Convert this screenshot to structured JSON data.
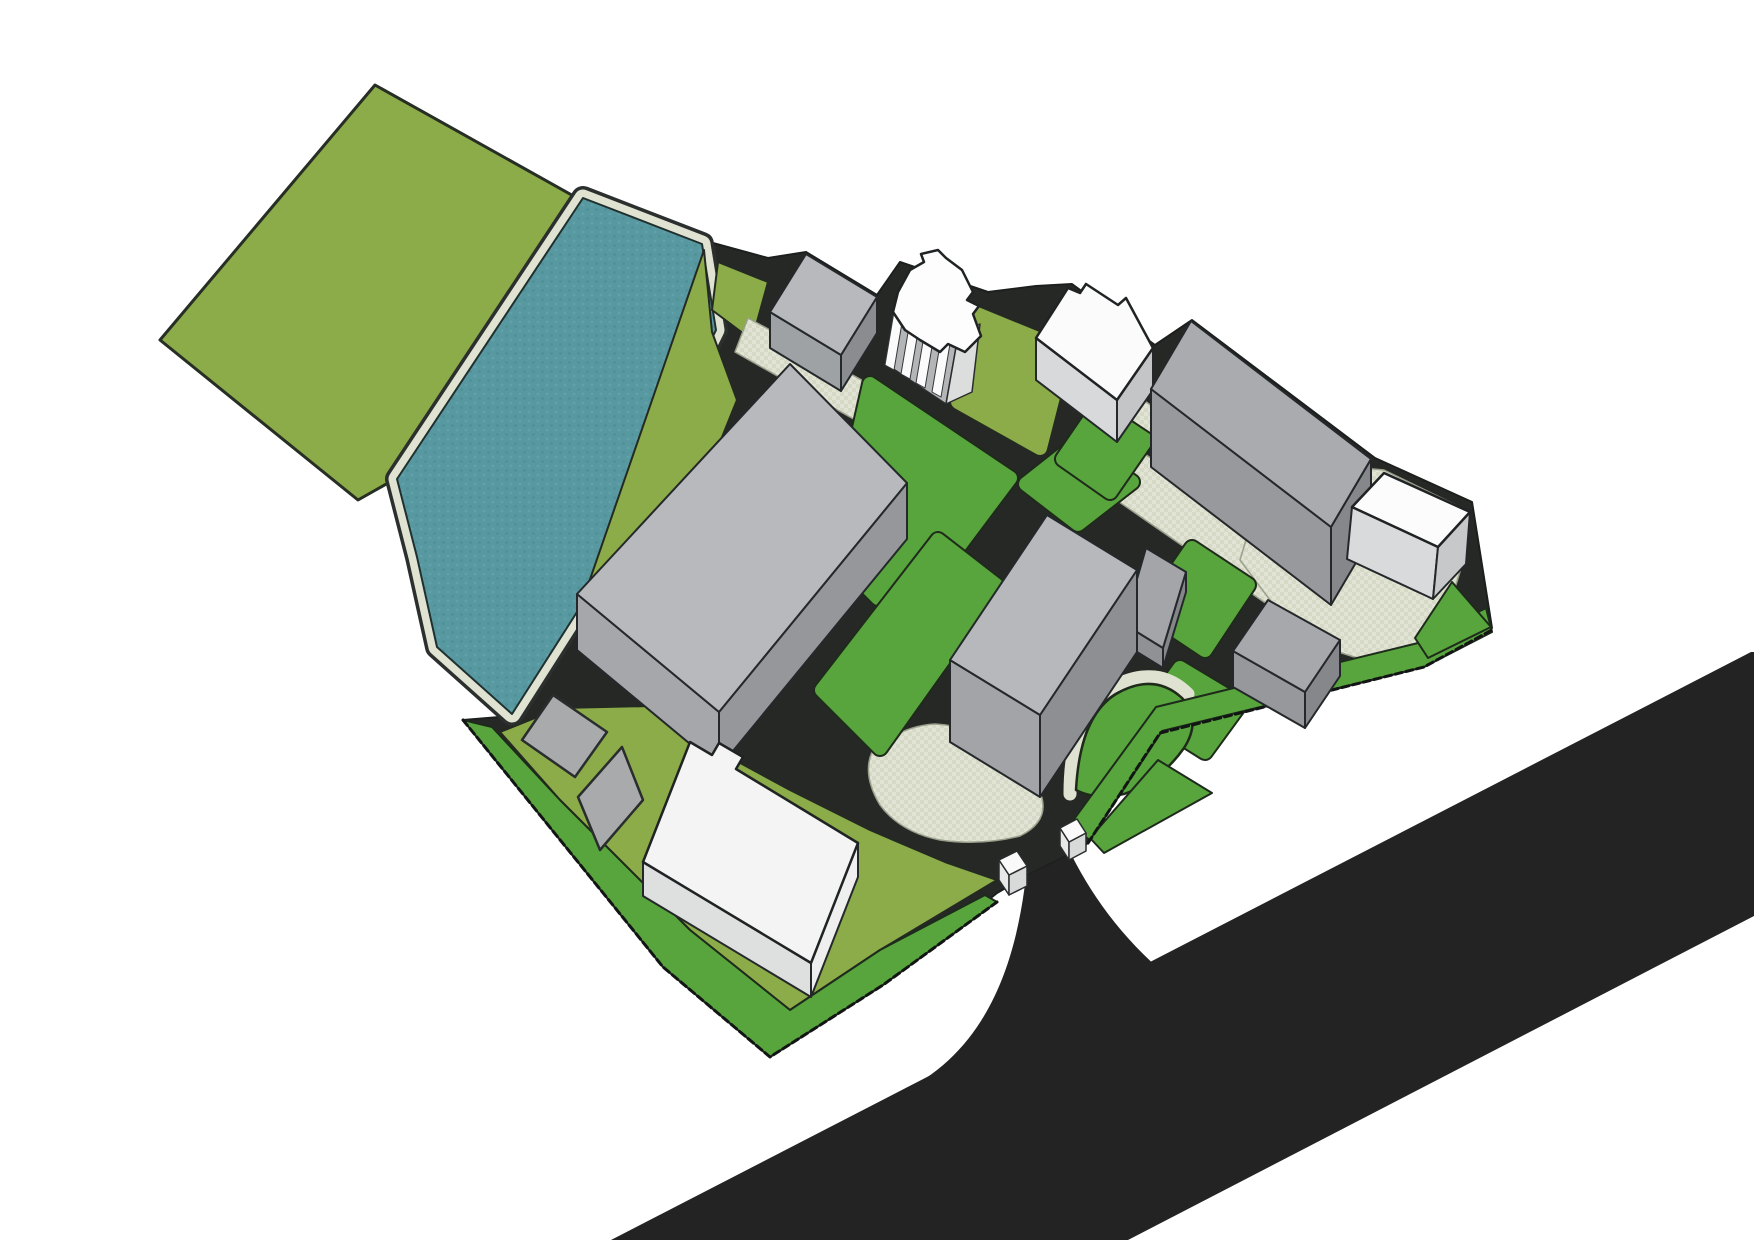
{
  "canvas": {
    "width": 1754,
    "height": 1240,
    "background": "#ffffff"
  },
  "scene": {
    "kind": "3d-site-plan-massing-rendering",
    "counts": {
      "buildings": 11,
      "lawn_islands": 10,
      "plazas": 5,
      "gate_pillars": 2,
      "water_bodies": 1,
      "fields": 1,
      "roads": 2
    }
  },
  "palette": {
    "background": "#ffffff",
    "field_olive": "#8cab49",
    "lawn_green": "#57a53c",
    "pond_teal": "#5899a1",
    "pond_teal_dark": "#4f9097",
    "pond_teal_light": "#61a2aa",
    "walkway_light": "#e0e3d2",
    "walkway_check": "#d5d9c6",
    "site_asphalt": "#262826",
    "highway_black": "#232323",
    "building_gray_roof": "#b7b9bc",
    "building_gray_face": "#95979a",
    "building_white": "#f4f4f4",
    "outline_dark": "#20241f"
  },
  "elements": [
    {
      "name": "meadow-field",
      "kind": "polygon",
      "points": "375,85 620,222 600,242 397,478 358,500 160,340",
      "fill": "#8cab49",
      "stroke": "#272e24",
      "strokeWidth": 3
    },
    {
      "name": "site-ground-asphalt",
      "kind": "polygon",
      "points": "702,240 768,258 806,252 877,295 900,262 988,292 1036,286 1072,284 1155,345 1192,320 1375,458 1472,502 1492,628 1424,667 1160,733 1088,843 1072,853 1028,875 997,893 883,985 770,1057 663,967 463,720 512,716 577,610 716,332",
      "fill": "#262826",
      "stroke": "#1b1f1d",
      "strokeWidth": 2
    },
    {
      "name": "pond-rim-outline",
      "kind": "polygon",
      "points": "583,198 702,244 716,330 577,612 512,714 437,647 417,557 397,479",
      "fill": "none",
      "stroke": "#2b302e",
      "strokeWidth": 24,
      "join": "round"
    },
    {
      "name": "pond-walkway",
      "kind": "polygon",
      "points": "583,198 702,244 716,330 577,612 512,714 437,647 417,557 397,479",
      "fill": "none",
      "stroke": "#e0e3d2",
      "strokeWidth": 17,
      "join": "round"
    },
    {
      "name": "pond",
      "kind": "polygon",
      "points": "583,198 702,244 716,330 577,612 512,714 437,647 417,557 397,479",
      "fill": "url(#pondtex)",
      "stroke": "#20302e",
      "strokeWidth": 2
    },
    {
      "name": "olive-band-waterside",
      "kind": "polygon",
      "points": "704,250 712,332 737,400 666,576 600,655 578,614",
      "fill": "#8cab49",
      "stroke": "#242a22",
      "strokeWidth": 2
    },
    {
      "name": "olive-knoll-north",
      "kind": "polygon",
      "points": "718,262 768,282 752,340 712,310",
      "fill": "#8cab49",
      "stroke": "#242a22",
      "strokeWidth": 2
    },
    {
      "name": "olive-court-north",
      "kind": "polygon",
      "points": "972,312 1065,350 1040,448 958,402",
      "fill": "#8cab49",
      "outline": "#242a22",
      "rounded": true
    },
    {
      "name": "olive-lawn-southwest",
      "kind": "polygon",
      "points": "560,708 650,706 720,752 790,790 870,830 945,862 997,880 880,950 790,1010 690,930 560,800 500,732",
      "fill": "#8cab49",
      "stroke": "#242a22",
      "strokeWidth": 2
    },
    {
      "name": "green-strip-southwest-boundary",
      "kind": "polygon",
      "points": "463,720 663,967 770,1057 883,985 997,902 985,895 880,950 790,1010 690,930 560,800 492,727",
      "fill": "#57a53c",
      "stroke": "#1e2a1c",
      "strokeWidth": 2
    },
    {
      "name": "plaza-north",
      "kind": "polygon",
      "points": "748,318 902,402 880,434 735,352",
      "fill": "url(#pavetex)",
      "stroke": "#9aa08c",
      "strokeWidth": 1.5
    },
    {
      "name": "plaza-sliver-north",
      "kind": "polygon",
      "points": "1130,390 1160,412 1146,450 1116,426",
      "fill": "url(#pavetex)",
      "stroke": "#9aa08c",
      "strokeWidth": 1.5
    },
    {
      "name": "plaza-east-band",
      "kind": "polygon",
      "points": "1142,452 1352,598 1322,642 1112,497",
      "fill": "url(#pavetex)",
      "stroke": "#9aa08c",
      "strokeWidth": 1.5
    },
    {
      "name": "plaza-east",
      "kind": "polygon",
      "points": "1252,520 1340,466 1384,470 1470,512 1462,565 1436,650 1380,665 1300,640 1240,560",
      "fill": "url(#pavetex)",
      "stroke": "#9aa08c",
      "strokeWidth": 1.5
    },
    {
      "name": "plaza-tower-base",
      "kind": "path",
      "d": "M 872,752 Q 900,726 935,724 Q 975,726 1005,752 Q 1030,772 1042,798 Q 1048,822 1020,836 Q 980,846 940,840 Q 900,832 880,805 Q 862,775 872,752 Z",
      "fill": "url(#pavetex)",
      "stroke": "#9aa08c",
      "strokeWidth": 1.5
    },
    {
      "name": "lawn-north-central",
      "kind": "polygon",
      "points": "870,384 1010,478 944,566 878,598 832,552",
      "fill": "#57a53c",
      "outline": "#1f2a1b",
      "rounded": true
    },
    {
      "name": "lawn-central-west",
      "kind": "polygon",
      "points": "938,540 996,585 880,748 822,690",
      "fill": "#57a53c",
      "outline": "#1f2a1b",
      "rounded": true
    },
    {
      "name": "lawn-central-east",
      "kind": "polygon",
      "points": "1078,443 1132,482 1078,524 1026,484",
      "fill": "#57a53c",
      "outline": "#1f2a1b",
      "rounded": true
    },
    {
      "name": "lawn-east-upper",
      "kind": "polygon",
      "points": "1098,408 1146,440 1110,492 1063,459",
      "fill": "#57a53c",
      "outline": "#1f2a1b",
      "rounded": true
    },
    {
      "name": "lawn-east-mid",
      "kind": "polygon",
      "points": "1192,548 1248,585 1205,650 1148,612",
      "fill": "#57a53c",
      "outline": "#1f2a1b",
      "rounded": true
    },
    {
      "name": "lawn-east-lower",
      "kind": "polygon",
      "points": "1180,668 1240,704 1205,752 1146,715",
      "fill": "#57a53c",
      "outline": "#1f2a1b",
      "rounded": true
    },
    {
      "name": "teardrop-walkway",
      "kind": "path",
      "d": "M 1070,794 Q 1070,710 1114,686 Q 1158,664 1188,694",
      "fill": "none",
      "stroke": "#dfe2d1",
      "strokeWidth": 13
    },
    {
      "name": "lawn-teardrop",
      "kind": "path",
      "d": "M 1076,790 Q 1080,716 1116,694 Q 1154,672 1182,698 Q 1202,720 1184,748 Q 1160,782 1124,794 Q 1094,800 1076,790 Z",
      "fill": "#57a53c",
      "stroke": "#1f2a1b",
      "strokeWidth": 2.5
    },
    {
      "name": "lawn-gate-east",
      "kind": "polygon",
      "points": "1090,838 1158,760 1212,793 1104,853",
      "fill": "#57a53c",
      "stroke": "#1e2a1c",
      "strokeWidth": 2
    },
    {
      "name": "green-strip-southeast-boundary",
      "kind": "polygon",
      "points": "1492,632 1424,667 1162,731 1090,840 1069,826 1156,707 1418,643 1486,608",
      "fill": "#57a53c",
      "stroke": "#1e2a1c",
      "strokeWidth": 2
    },
    {
      "name": "lawn-east-tip-triangle",
      "kind": "polygon",
      "points": "1452,582 1491,627 1428,658 1415,638",
      "fill": "#57a53c",
      "stroke": "#1e2a1c",
      "strokeWidth": 2
    },
    {
      "name": "highway",
      "kind": "polygon",
      "points": "611,1240 1751,652 1754,652 1754,916 1128,1240",
      "fill": "#232323",
      "stroke": "none",
      "strokeWidth": 0
    },
    {
      "name": "access-road",
      "kind": "path",
      "d": "M 1026,876 L 1071,854 C 1098,908 1140,962 1210,1008 L 1285,1052 L 898,1094 C 988,1052 1016,962 1026,876 Z",
      "fill": "#232323",
      "stroke": "none",
      "strokeWidth": 0
    },
    {
      "name": "boundary-edge-southwest",
      "kind": "polyline",
      "points": "463,720 663,967 770,1057 883,985 997,902",
      "fill": "none",
      "stroke": "#121514",
      "strokeWidth": 3,
      "dash": "7 4"
    },
    {
      "name": "boundary-edge-southeast",
      "kind": "polyline",
      "points": "1088,843 1160,733 1424,667 1492,630",
      "fill": "none",
      "stroke": "#121514",
      "strokeWidth": 3,
      "dash": "7 4"
    },
    {
      "name": "building-north-small-face-sw",
      "kind": "polygon",
      "points": "770,312 841,355 841,391 770,348",
      "fill": "#9fa2a4",
      "stroke": "#24282a",
      "strokeWidth": 2
    },
    {
      "name": "building-north-small-face-se",
      "kind": "polygon",
      "points": "841,355 877,297 877,333 841,391",
      "fill": "#8a8c8f",
      "stroke": "#24282a",
      "strokeWidth": 2
    },
    {
      "name": "building-north-small-roof",
      "kind": "polygon",
      "points": "806,254 877,297 841,355 770,312",
      "fill": "#b7b9bc",
      "stroke": "#24282a",
      "strokeWidth": 2
    },
    {
      "name": "tower-cross-face-base",
      "kind": "polygon",
      "points": "896,300 958,336 946,404 886,364",
      "fill": "#b3b5b7",
      "stroke": "#2a2d2e",
      "strokeWidth": 1.5
    },
    {
      "name": "tower-cross-face-se",
      "kind": "polygon",
      "points": "958,336 980,324 972,392 946,404",
      "fill": "#dcdddd",
      "stroke": "#2a2d2e",
      "strokeWidth": 1.5
    },
    {
      "name": "tower-cross-pilaster-1",
      "kind": "polygon",
      "points": "896,300 905,305 894,370 885,365",
      "fill": "#fbfbfb",
      "stroke": "#33383a",
      "strokeWidth": 1
    },
    {
      "name": "tower-cross-pilaster-2",
      "kind": "polygon",
      "points": "912,309 921,314 910,379 901,374",
      "fill": "#fbfbfb",
      "stroke": "#33383a",
      "strokeWidth": 1
    },
    {
      "name": "tower-cross-pilaster-3",
      "kind": "polygon",
      "points": "927,318 936,323 925,388 916,383",
      "fill": "#fbfbfb",
      "stroke": "#33383a",
      "strokeWidth": 1
    },
    {
      "name": "tower-cross-pilaster-4",
      "kind": "polygon",
      "points": "943,327 952,332 941,397 932,392",
      "fill": "#fbfbfb",
      "stroke": "#33383a",
      "strokeWidth": 1
    },
    {
      "name": "tower-cross-roof",
      "kind": "polygon",
      "points": "898,292 910,270 924,262 921,254 938,250 946,258 962,270 973,292 967,300 979,306 973,314 981,336 965,352 948,344 940,352 920,340 905,330 893,312",
      "fill": "#fdfdfd",
      "stroke": "#202324",
      "strokeWidth": 2.5
    },
    {
      "name": "building-white-north-face-sw",
      "kind": "polygon",
      "points": "1036,338 1117,400 1117,442 1036,380",
      "fill": "#d8d9da",
      "stroke": "#24282a",
      "strokeWidth": 2
    },
    {
      "name": "building-white-north-face-se",
      "kind": "polygon",
      "points": "1117,400 1153,348 1153,390 1117,442",
      "fill": "#c3c5c7",
      "stroke": "#24282a",
      "strokeWidth": 2
    },
    {
      "name": "building-white-north-roof",
      "kind": "polygon",
      "points": "1036,338 1068,288 1080,293 1086,284 1118,305 1126,298 1153,348 1117,400",
      "fill": "#fbfbfc",
      "stroke": "#202324",
      "strokeWidth": 2.5
    },
    {
      "name": "building-east-large-face-sw",
      "kind": "polygon",
      "points": "1151,389 1331,527 1331,605 1151,467",
      "fill": "#97999c",
      "stroke": "#24282a",
      "strokeWidth": 2
    },
    {
      "name": "building-east-large-face-se",
      "kind": "polygon",
      "points": "1331,527 1371,459 1371,537 1331,605",
      "fill": "#85878a",
      "stroke": "#24282a",
      "strokeWidth": 2
    },
    {
      "name": "building-east-large-roof",
      "kind": "polygon",
      "points": "1191,321 1371,459 1331,527 1151,389",
      "fill": "#a9abae",
      "stroke": "#24282a",
      "strokeWidth": 2
    },
    {
      "name": "building-east-white-face-sw",
      "kind": "polygon",
      "points": "1352,507 1438,547 1433,599 1347,559",
      "fill": "#d9dadb",
      "stroke": "#24282a",
      "strokeWidth": 2
    },
    {
      "name": "building-east-white-face-se",
      "kind": "polygon",
      "points": "1438,547 1470,512 1466,564 1433,599",
      "fill": "#c6c8ca",
      "stroke": "#24282a",
      "strokeWidth": 2
    },
    {
      "name": "building-east-white-roof",
      "kind": "polygon",
      "points": "1384,473 1470,512 1438,547 1352,507",
      "fill": "#fcfcfd",
      "stroke": "#202324",
      "strokeWidth": 2.5
    },
    {
      "name": "building-mid-sliver-face-sw",
      "kind": "polygon",
      "points": "1124,624 1163,648 1163,668 1124,644",
      "fill": "#8f9194",
      "stroke": "#24282a",
      "strokeWidth": 2
    },
    {
      "name": "building-mid-sliver-face-se",
      "kind": "polygon",
      "points": "1163,648 1186,572 1186,592 1163,668",
      "fill": "#84868a",
      "stroke": "#24282a",
      "strokeWidth": 2
    },
    {
      "name": "building-mid-sliver-roof",
      "kind": "polygon",
      "points": "1146,548 1186,572 1163,648 1124,624",
      "fill": "#a3a5a8",
      "stroke": "#24282a",
      "strokeWidth": 2
    },
    {
      "name": "building-southeast-small-face-sw",
      "kind": "polygon",
      "points": "1233,651 1305,692 1305,728 1233,687",
      "fill": "#96989b",
      "stroke": "#24282a",
      "strokeWidth": 2
    },
    {
      "name": "building-southeast-small-face-se",
      "kind": "polygon",
      "points": "1305,692 1340,640 1340,676 1305,728",
      "fill": "#85878a",
      "stroke": "#24282a",
      "strokeWidth": 2
    },
    {
      "name": "building-southeast-small-roof",
      "kind": "polygon",
      "points": "1268,600 1340,640 1305,692 1233,651",
      "fill": "#a6a8ab",
      "stroke": "#24282a",
      "strokeWidth": 2
    },
    {
      "name": "tower-central-face-sw",
      "kind": "polygon",
      "points": "950,660 1040,715 1040,797 950,742",
      "fill": "#a2a4a7",
      "stroke": "#24282a",
      "strokeWidth": 2
    },
    {
      "name": "tower-central-face-se",
      "kind": "polygon",
      "points": "1040,715 1137,570 1137,652 1040,797",
      "fill": "#8d8f92",
      "stroke": "#24282a",
      "strokeWidth": 2
    },
    {
      "name": "tower-central-roof",
      "kind": "polygon",
      "points": "1047,515 1137,570 1040,715 950,660",
      "fill": "#b6b8bb",
      "stroke": "#24282a",
      "strokeWidth": 2
    },
    {
      "name": "building-central-large-face-sw",
      "kind": "polygon",
      "points": "577,594 719,712 719,768 577,650",
      "fill": "#a5a7aa",
      "stroke": "#24282a",
      "strokeWidth": 2
    },
    {
      "name": "building-central-large-face-se",
      "kind": "polygon",
      "points": "719,712 907,483 907,539 719,768",
      "fill": "#95979a",
      "stroke": "#24282a",
      "strokeWidth": 2
    },
    {
      "name": "building-central-large-roof",
      "kind": "polygon",
      "points": "790,364 907,483 719,712 577,594",
      "fill": "#b7b9bc",
      "stroke": "#24282a",
      "strokeWidth": 2
    },
    {
      "name": "pad-southwest-1",
      "kind": "polygon",
      "points": "553,695 607,732 575,777 522,740",
      "fill": "#a8aaac",
      "stroke": "#2a2d2e",
      "strokeWidth": 2.5
    },
    {
      "name": "pad-southwest-2",
      "kind": "polygon",
      "points": "622,747 643,800 600,850 578,797",
      "fill": "#a8aaac",
      "stroke": "#2a2d2e",
      "strokeWidth": 2.5
    },
    {
      "name": "building-white-southwest-face-sw",
      "kind": "polygon",
      "points": "643,862 811,963 811,997 643,896",
      "fill": "#dedfdf",
      "stroke": "#24282a",
      "strokeWidth": 2
    },
    {
      "name": "building-white-southwest-face-se",
      "kind": "polygon",
      "points": "811,963 858,843 858,877 811,997",
      "fill": "#efefef",
      "stroke": "#24282a",
      "strokeWidth": 2
    },
    {
      "name": "building-white-southwest-roof",
      "kind": "polygon",
      "points": "690,742 712,755 719,743 743,757 736,769 858,843 811,963 643,862",
      "fill": "#f4f4f4",
      "stroke": "#202324",
      "strokeWidth": 2.5
    },
    {
      "name": "gate-pillar-west-face-sw",
      "kind": "polygon",
      "points": "999,860 1009,875 1009,895 999,880",
      "fill": "#e8e8e8",
      "stroke": "#2a2d2e",
      "strokeWidth": 1.5
    },
    {
      "name": "gate-pillar-west-face-se",
      "kind": "polygon",
      "points": "1009,875 1027,866 1027,886 1009,895",
      "fill": "#d8d9d9",
      "stroke": "#2a2d2e",
      "strokeWidth": 1.5
    },
    {
      "name": "gate-pillar-west-roof",
      "kind": "polygon",
      "points": "999,860 1017,851 1027,866 1009,875",
      "fill": "#fafafa",
      "stroke": "#2a2d2e",
      "strokeWidth": 1.5
    },
    {
      "name": "gate-pillar-east-face-sw",
      "kind": "polygon",
      "points": "1060,828 1069,842 1069,860 1060,846",
      "fill": "#e8e8e8",
      "stroke": "#2a2d2e",
      "strokeWidth": 1.5
    },
    {
      "name": "gate-pillar-east-face-se",
      "kind": "polygon",
      "points": "1069,842 1086,833 1086,851 1069,860",
      "fill": "#d8d9d9",
      "stroke": "#2a2d2e",
      "strokeWidth": 1.5
    },
    {
      "name": "gate-pillar-east-roof",
      "kind": "polygon",
      "points": "1060,828 1077,819 1086,833 1069,842",
      "fill": "#fafafa",
      "stroke": "#2a2d2e",
      "strokeWidth": 1.5
    }
  ]
}
